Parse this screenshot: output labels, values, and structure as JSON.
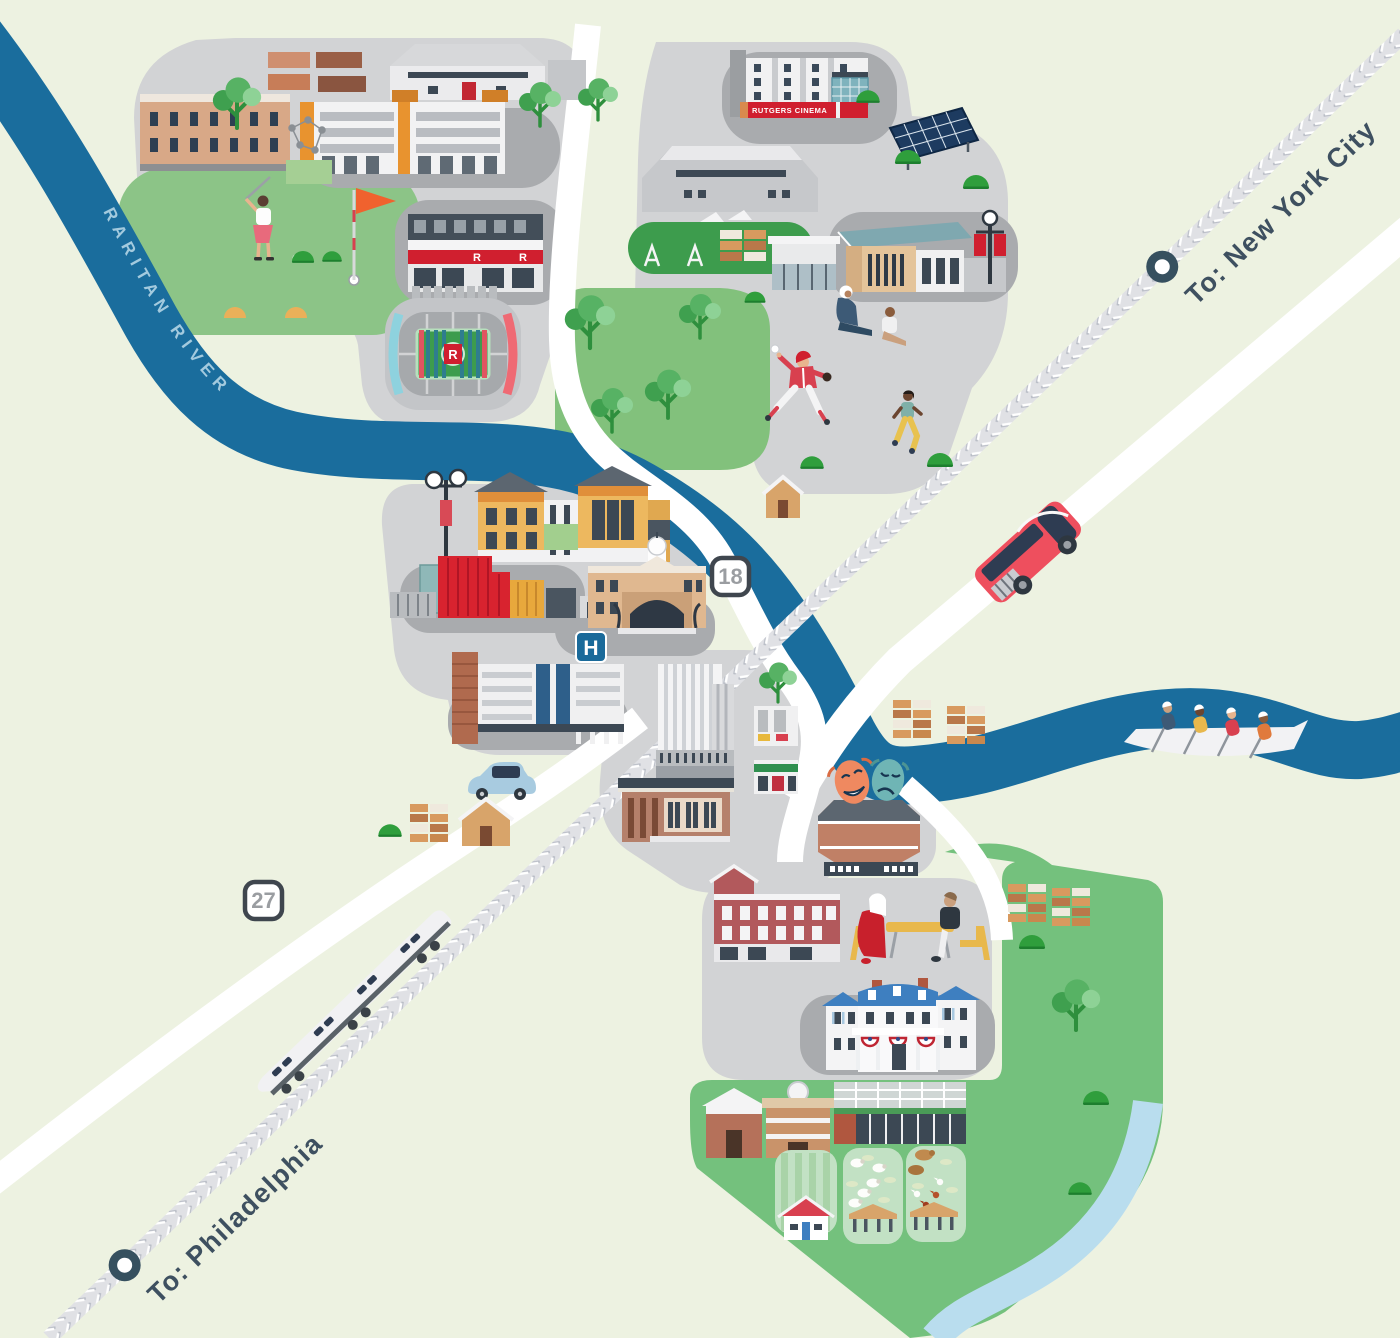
{
  "map": {
    "labels": {
      "river": "RARITAN RIVER",
      "to_new_york": "To: New York City",
      "to_philadelphia": "To: Philadelphia"
    },
    "route_shields": [
      {
        "number": "18"
      },
      {
        "number": "27"
      }
    ],
    "signs": {
      "cinema": "RUTGERS CINEMA",
      "hospital_symbol": "H",
      "hospital_name": "RWJ",
      "stadium_letter": "R",
      "storefront_letter": "R"
    },
    "colors": {
      "background": "#edf2e1",
      "river": "#1a6d9d",
      "river-label": "#a3cade",
      "stream": "#b9ddee",
      "campus": "#d2d3d5",
      "plaza": "#a9abae",
      "grass": "#8cc487",
      "park": "#82c17c",
      "farm": "#74c17d",
      "field": "#3d9c4d",
      "plot": "#c2e1c4",
      "road": "#ffffff",
      "rail": "#e0e1e5",
      "rail-chevron": "#b9bdc6",
      "label": "#3e5060",
      "rutgers-red": "#d01f2f",
      "bus-red": "#ee4f5e",
      "sign-blue": "#1a6a9a",
      "rwj-orange": "#c0541c",
      "mansion-roof": "#3e7fc0"
    }
  }
}
